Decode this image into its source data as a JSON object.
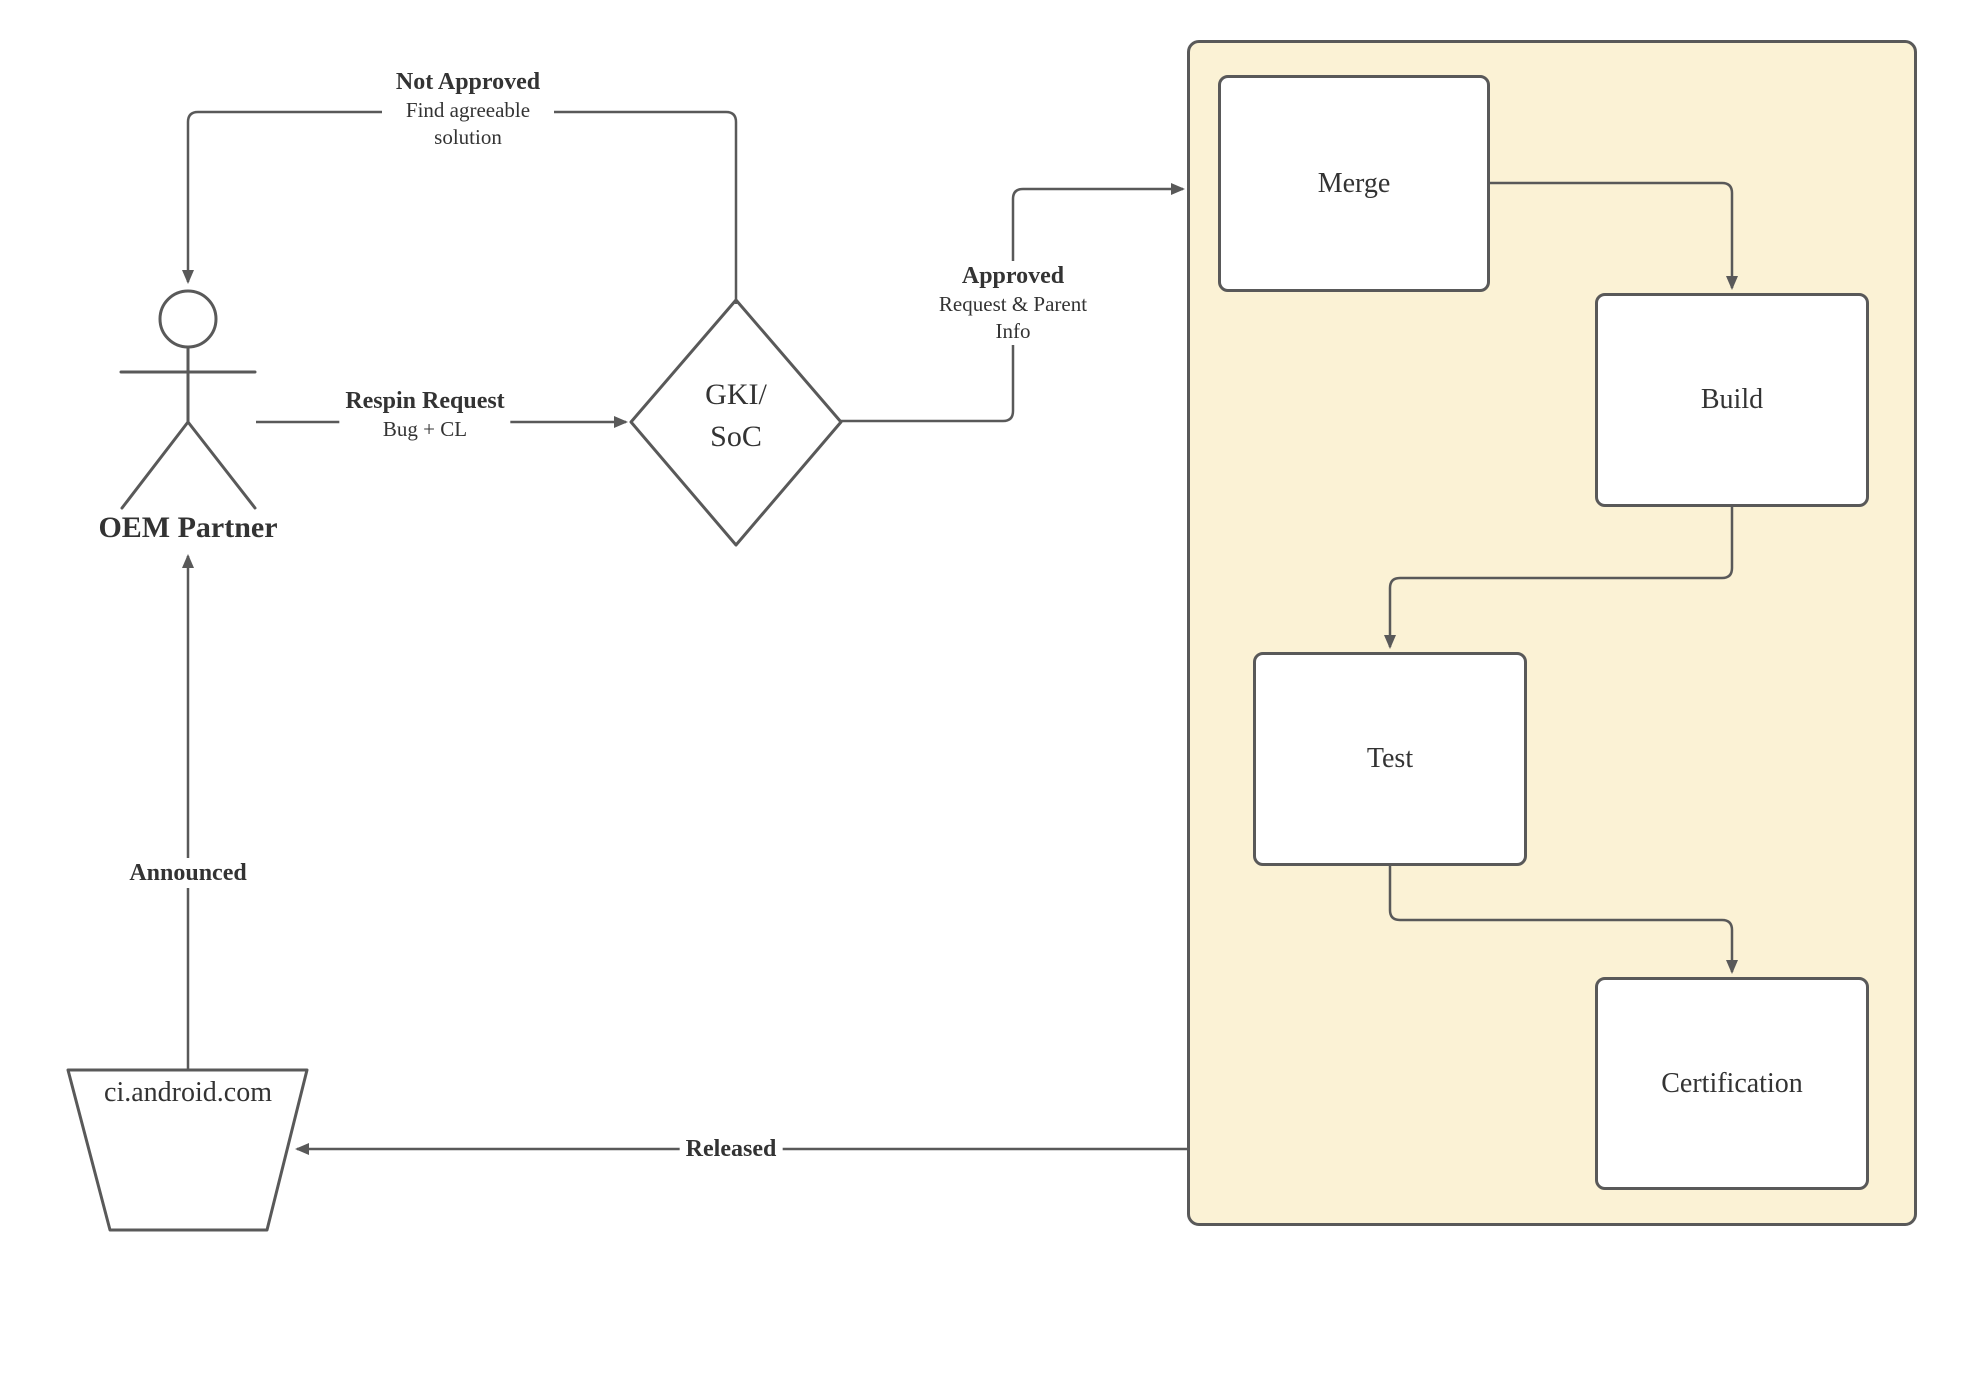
{
  "diagram": {
    "colors": {
      "stroke": "#595959",
      "text": "#333333",
      "container_fill": "#FBF2D5",
      "node_fill": "#ffffff"
    },
    "actor": {
      "label": "OEM Partner"
    },
    "decision": {
      "line1": "GKI/",
      "line2": "SoC"
    },
    "datastore": {
      "label": "ci.android.com"
    },
    "container": {
      "nodes": [
        {
          "label": "Merge"
        },
        {
          "label": "Build"
        },
        {
          "label": "Test"
        },
        {
          "label": "Certification"
        }
      ]
    },
    "edges": {
      "not_approved": {
        "title": "Not Approved",
        "subtitle": "Find agreeable solution"
      },
      "respin_request": {
        "title": "Respin Request",
        "subtitle": "Bug + CL"
      },
      "approved": {
        "title": "Approved",
        "subtitle": "Request & Parent Info"
      },
      "announced": {
        "title": "Announced"
      },
      "released": {
        "title": "Released"
      }
    }
  }
}
